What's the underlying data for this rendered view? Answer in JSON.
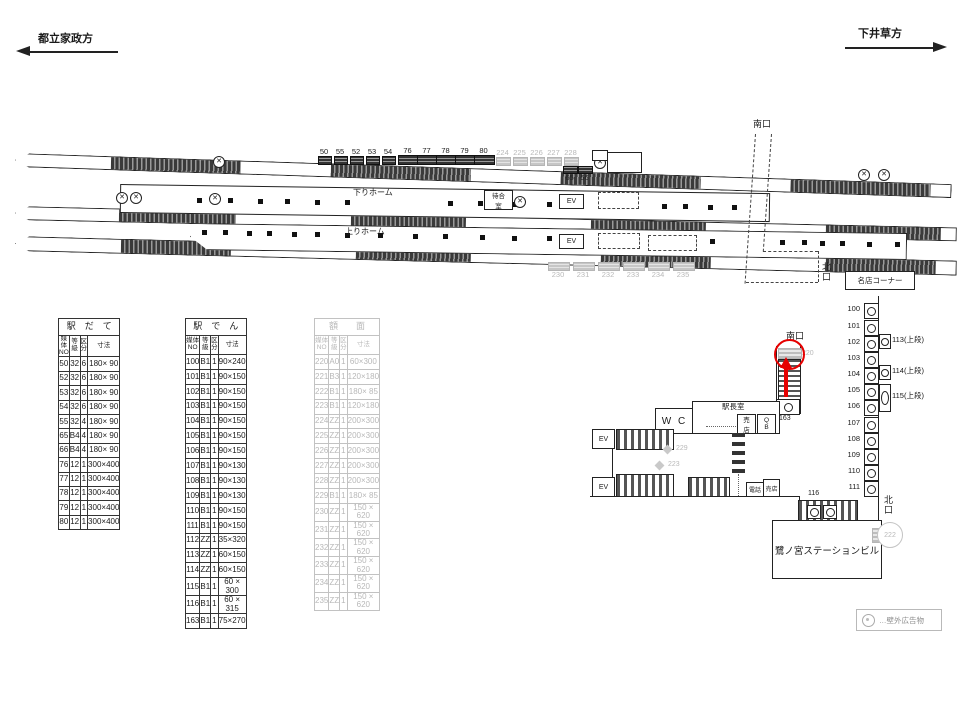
{
  "header": {
    "left_label": "都立家政方",
    "right_label": "下井草方"
  },
  "diagram": {
    "down_platform_label": "下りホーム",
    "up_platform_label": "上りホーム",
    "waiting_room_label": "待合\n室",
    "ev_label": "EV",
    "south_exit_label": "南口",
    "north_exit_label": "北\n口",
    "meiten_corner_label": "名店コーナー",
    "ads": {
      "top_small": [
        "50",
        "55",
        "52",
        "53",
        "54"
      ],
      "top_wide": [
        "76",
        "77",
        "78",
        "79",
        "80"
      ],
      "top_gray": [
        "224",
        "225",
        "226",
        "227",
        "228"
      ],
      "top_pair": [
        "65",
        "66"
      ],
      "bottom_gray": [
        "230",
        "231",
        "232",
        "233",
        "234",
        "235"
      ]
    }
  },
  "tables": [
    {
      "title": "駅　だ　て",
      "headers": [
        "媒体\nNO",
        "等\n級",
        "区\n分",
        "寸法"
      ],
      "rows": [
        [
          "50",
          "32",
          "6",
          "180× 90"
        ],
        [
          "52",
          "32",
          "6",
          "180× 90"
        ],
        [
          "53",
          "32",
          "6",
          "180× 90"
        ],
        [
          "54",
          "32",
          "6",
          "180× 90"
        ],
        [
          "55",
          "32",
          "4",
          "180× 90"
        ],
        [
          "65",
          "B4",
          "4",
          "180× 90"
        ],
        [
          "66",
          "B4",
          "4",
          "180× 90"
        ],
        [
          "76",
          "12",
          "1",
          "300×400"
        ],
        [
          "77",
          "12",
          "1",
          "300×400"
        ],
        [
          "78",
          "12",
          "1",
          "300×400"
        ],
        [
          "79",
          "12",
          "1",
          "300×400"
        ],
        [
          "80",
          "12",
          "1",
          "300×400"
        ]
      ],
      "gray": false
    },
    {
      "title": "駅　で　ん",
      "headers": [
        "媒体\nNO",
        "等\n級",
        "区\n分",
        "寸法"
      ],
      "rows": [
        [
          "100",
          "B1",
          "1",
          "90×240"
        ],
        [
          "101",
          "B1",
          "1",
          "90×150"
        ],
        [
          "102",
          "B1",
          "1",
          "90×150"
        ],
        [
          "103",
          "B1",
          "1",
          "90×150"
        ],
        [
          "104",
          "B1",
          "1",
          "90×150"
        ],
        [
          "105",
          "B1",
          "1",
          "90×150"
        ],
        [
          "106",
          "B1",
          "1",
          "90×150"
        ],
        [
          "107",
          "B1",
          "1",
          "90×130"
        ],
        [
          "108",
          "B1",
          "1",
          "90×130"
        ],
        [
          "109",
          "B1",
          "1",
          "90×130"
        ],
        [
          "110",
          "B1",
          "1",
          "90×150"
        ],
        [
          "111",
          "B1",
          "1",
          "90×150"
        ],
        [
          "112",
          "ZZ",
          "1",
          "35×320"
        ],
        [
          "113",
          "ZZ",
          "1",
          "60×150"
        ],
        [
          "114",
          "ZZ",
          "1",
          "60×150"
        ],
        [
          "115",
          "B1",
          "1",
          "60 × 300"
        ],
        [
          "116",
          "B1",
          "1",
          "60 × 315"
        ],
        [
          "163",
          "B1",
          "1",
          "75×270"
        ]
      ],
      "gray": false
    },
    {
      "title": "額　　面",
      "headers": [
        "媒体\nNO",
        "等\n級",
        "区\n分",
        "寸法"
      ],
      "rows": [
        [
          "220",
          "A0",
          "1",
          "60×300"
        ],
        [
          "221",
          "B3",
          "1",
          "120×180"
        ],
        [
          "222",
          "B1",
          "1",
          "180× 85"
        ],
        [
          "223",
          "B1",
          "1",
          "120×180"
        ],
        [
          "224",
          "ZZ",
          "1",
          "200×300"
        ],
        [
          "225",
          "ZZ",
          "1",
          "200×300"
        ],
        [
          "226",
          "ZZ",
          "1",
          "200×300"
        ],
        [
          "227",
          "ZZ",
          "1",
          "200×300"
        ],
        [
          "228",
          "ZZ",
          "1",
          "200×300"
        ],
        [
          "229",
          "B1",
          "1",
          "180× 85"
        ],
        [
          "230",
          "ZZ",
          "1",
          "150 × 620"
        ],
        [
          "231",
          "ZZ",
          "1",
          "150 × 620"
        ],
        [
          "232",
          "ZZ",
          "1",
          "150 × 620"
        ],
        [
          "233",
          "ZZ",
          "1",
          "150 × 620"
        ],
        [
          "234",
          "ZZ",
          "1",
          "150 × 620"
        ],
        [
          "235",
          "ZZ",
          "1",
          "150 × 620"
        ]
      ],
      "gray": true
    }
  ],
  "concourse": {
    "south_exit_label": "南口",
    "north_exit_label": "北\n口",
    "wc_label": "W C",
    "station_master_label": "駅長室",
    "kiosk_label": "売\n店",
    "qb_label": "Q\nB",
    "phone_label": "電話",
    "shop_label": "売店",
    "ev_label": "EV",
    "building_label": "鷺ノ宮ステーションビル",
    "strip": [
      "100",
      "101",
      "102",
      "103",
      "104",
      "105",
      "106",
      "107",
      "108",
      "109",
      "110",
      "111"
    ],
    "uppers": [
      "113(上段)",
      "114(上段)",
      "115(上段)"
    ],
    "labels": {
      "n220": "220",
      "n222": "222",
      "n229": "229",
      "n223": "223",
      "n163": "163",
      "n116": "116",
      "n112": "112"
    }
  },
  "legend": {
    "text": "…壁外広告物"
  }
}
